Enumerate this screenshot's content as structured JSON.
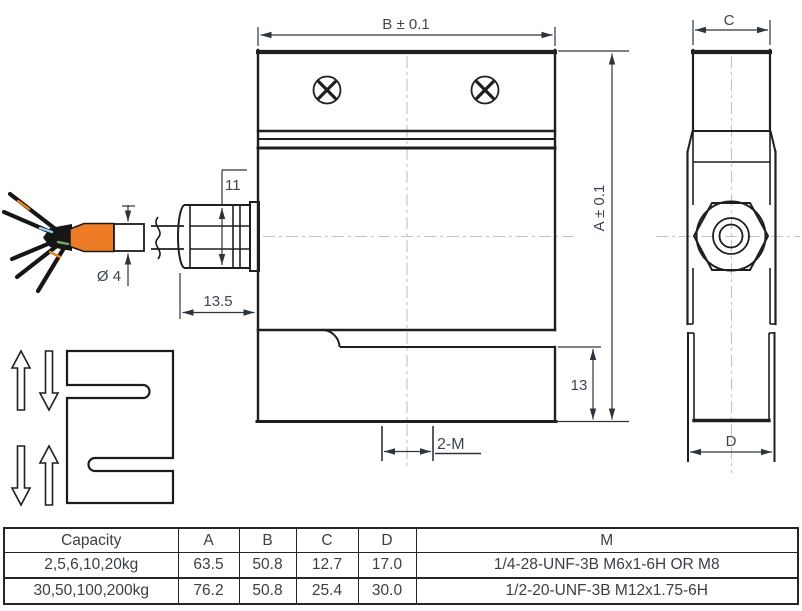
{
  "drawing": {
    "labels": {
      "dim_b": "B ± 0.1",
      "dim_a": "A ± 0.1",
      "gland_diameter": "11",
      "gland_length": "13.5",
      "cable_diameter": "Ø 4",
      "lower_block_height": "13",
      "thread_label": "2-M",
      "dim_c": "C",
      "dim_d": "D"
    }
  },
  "table": {
    "headers": [
      "Capacity",
      "A",
      "B",
      "C",
      "D",
      "M"
    ],
    "rows": [
      {
        "capacity": "2,5,6,10,20kg",
        "a": "63.5",
        "b": "50.8",
        "c": "12.7",
        "d": "17.0",
        "m": "1/4-28-UNF-3B M6x1-6H OR M8"
      },
      {
        "capacity": "30,50,100,200kg",
        "a": "76.2",
        "b": "50.8",
        "c": "25.4",
        "d": "30.0",
        "m": "1/2-20-UNF-3B  M12x1.75-6H"
      }
    ]
  },
  "colors": {
    "line": "#1d1f21",
    "dimension_text": "#3d4550",
    "centerline": "#c2c2c2",
    "cable_sleeve_orange": "#ee7c26",
    "wire_blue": "#8fd1ef",
    "wire_green": "#7fae67",
    "wire_orange": "#e8821f"
  }
}
